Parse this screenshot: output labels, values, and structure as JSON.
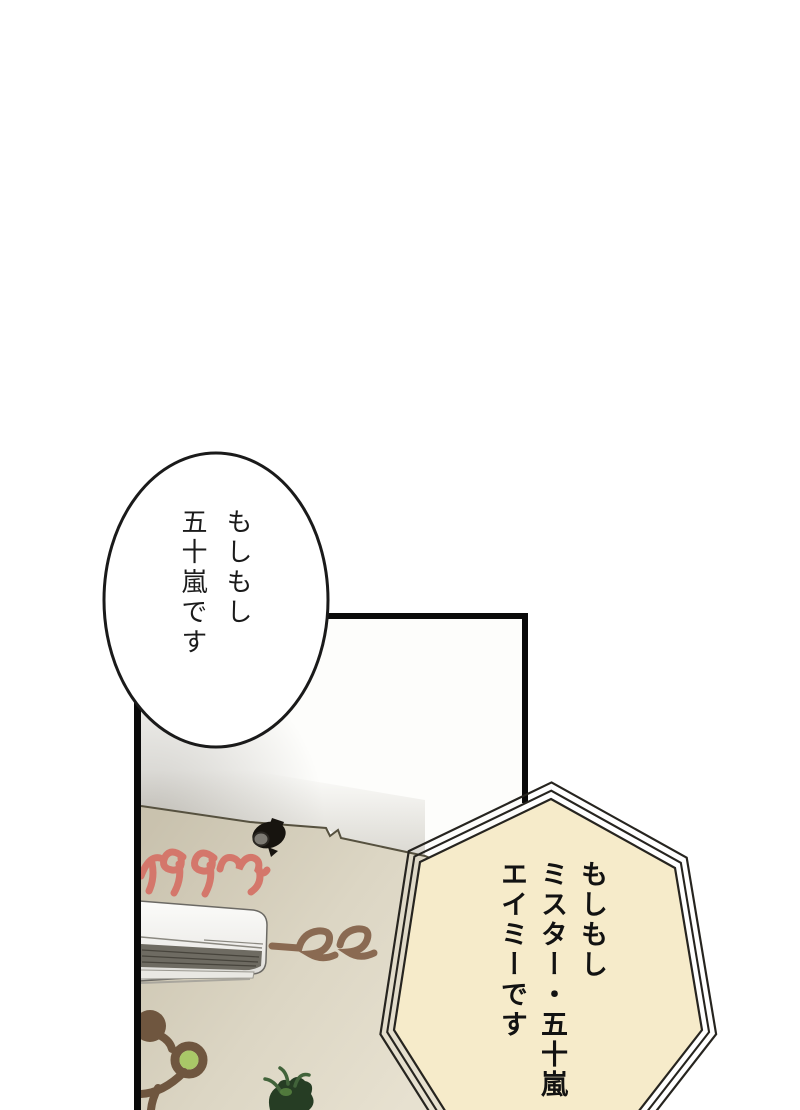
{
  "page": {
    "type": "manga page",
    "background_color": "#ffffff"
  },
  "speech_bubbles": {
    "ellipse": {
      "shape": "ellipse",
      "fill": "#ffffff",
      "border_color": "#1a1a1a",
      "lines": [
        "もしもし",
        "五十嵐です"
      ]
    },
    "heptagon": {
      "shape": "heptagon",
      "fill": "#f6ebca",
      "border_color": "#26241f",
      "lines": [
        "もしもし",
        "ミスター・五十嵐",
        "エイミーです"
      ]
    }
  },
  "panel": {
    "border_color": "#0a0a0a",
    "ceiling_color": "#fdfdfb",
    "wall_color_left": "#c9c2ae",
    "wall_color_right": "#e7e1d0",
    "wall_art": {
      "happy_script": {
        "visible_fragment": "ppy",
        "color": "#d4776b"
      },
      "tree_script": {
        "visible_fragment": "ree",
        "color": "#8a6a52"
      },
      "decal_branch_color": "#6f563f",
      "decal_berry_color": "#a9c868"
    },
    "objects": [
      "air conditioner",
      "ceiling spotlight",
      "potted plant",
      "tree wall decal"
    ]
  }
}
